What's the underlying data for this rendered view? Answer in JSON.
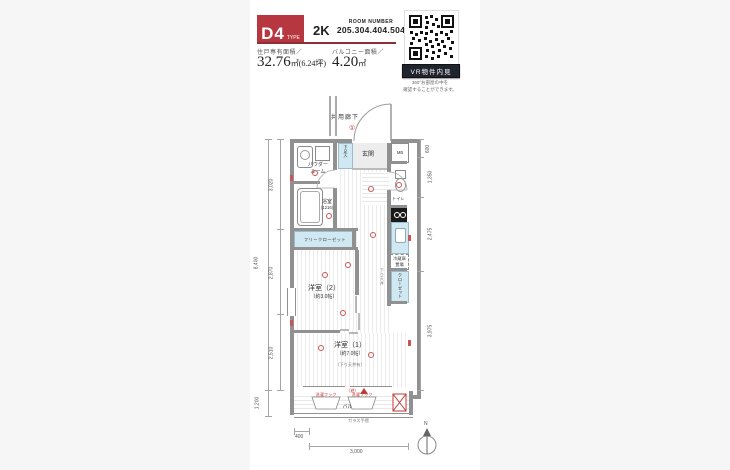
{
  "header": {
    "type_code": "D4",
    "type_label": "TYPE",
    "layout_type": "2K",
    "room_number_label": "ROOM NUMBER",
    "room_numbers": "205.304.404.504",
    "area_label": "住戸専有面積／",
    "area_main": "32.76",
    "area_unit": "㎡(6.24坪)",
    "balcony_label": "バルコニー面積／",
    "balcony_main": "4.20",
    "balcony_unit": "㎡",
    "vr_button_label": "VR物件内見",
    "vr_note_line1": "360°お部屋の中を",
    "vr_note_line2": "確認することができます。"
  },
  "plan": {
    "common_corridor": "共用廊下",
    "corridor_mark": "①",
    "entrance": "玄関",
    "meter_box": "MB",
    "shoe_box": "下足入",
    "powder_line1": "パウダー",
    "powder_line2": "ルーム",
    "bathroom": "浴室",
    "bathroom_size": "(1216)",
    "toilet": "トイレ",
    "fridge_line1": "冷蔵庫",
    "fridge_line2": "置場",
    "closet": "クローゼット",
    "free_closet": "フリークローゼット",
    "lowered_ceiling": "下り天井",
    "room2_name": "洋室（2）",
    "room2_size": "（約3.0帖）",
    "room1_name": "洋室（1）",
    "room1_size": "（約7.0帖）",
    "room1_note": "（下り天井有）",
    "balcony": "バルコニー",
    "glass_rail": "ガラス手摺",
    "laundry_hook": "洗濯フック",
    "evac_mark": "（避）",
    "compass": "N"
  },
  "dimensions": {
    "left_total": "8,400",
    "left_segments": [
      "3,020",
      "2,870",
      "2,510"
    ],
    "left_balcony": "1,200",
    "right_segments": [
      "600",
      "1,350",
      "2,475",
      "3,975"
    ],
    "bottom_offset": "400",
    "bottom_width": "3,000"
  },
  "colors": {
    "accent_red": "#b73741",
    "fixture_blue": "#cfe8f2",
    "wall_gray": "#919191",
    "symbol_red": "#c03a36"
  }
}
